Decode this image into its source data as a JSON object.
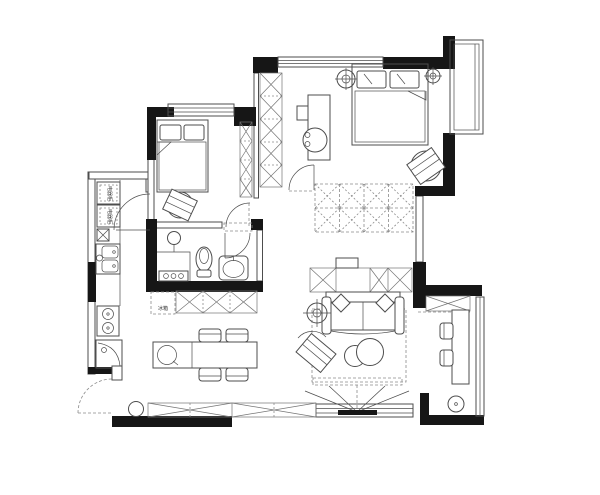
{
  "document": {
    "type": "apartment-floor-plan",
    "background": "#ffffff"
  },
  "colors": {
    "wall": "#161616",
    "line": "#4d4d4d",
    "hatch": "#757575",
    "dash": "#8a8a8a",
    "text": "#333333"
  },
  "labels": {
    "fridge": "冰箱",
    "kitchen_cabinet_top": "电器柜",
    "kitchen_cabinet_bottom": "电器柜"
  },
  "rooms": [
    {
      "name": "second-bedroom",
      "position": "top-left",
      "furniture": [
        "bed-with-two-pillows",
        "desk-chair",
        "wardrobe-column",
        "window",
        "door"
      ]
    },
    {
      "name": "master-bedroom",
      "position": "top-right",
      "furniture": [
        "double-bed-with-two-pillows",
        "ceiling-light",
        "ceiling-light",
        "dressing-table-with-stool",
        "lounge-chair",
        "double-row-wardrobe",
        "bay-window",
        "door"
      ]
    },
    {
      "name": "bathroom",
      "position": "middle-left",
      "furniture": [
        "makeup-mirror",
        "vanity-counter",
        "toilet",
        "wash-basin",
        "door"
      ]
    },
    {
      "name": "kitchen",
      "position": "left-strip",
      "furniture": [
        "appliance-cabinet",
        "appliance-cabinet",
        "double-bowl-sink",
        "two-burner-stove",
        "corner-counter",
        "door"
      ]
    },
    {
      "name": "dining-room",
      "position": "center",
      "furniture": [
        "refrigerator",
        "sideboard",
        "dining-table",
        "chair",
        "chair",
        "chair",
        "chair"
      ]
    },
    {
      "name": "living-room",
      "position": "center-right",
      "furniture": [
        "console-cabinet",
        "sofa",
        "throw-pillow",
        "throw-pillow",
        "floor-lamp",
        "armchair",
        "round-coffee-tables",
        "rug",
        "tv-with-view-lines",
        "window"
      ]
    },
    {
      "name": "balcony-study",
      "position": "bottom-right",
      "furniture": [
        "storage-cabinet",
        "desk",
        "chair",
        "chair",
        "floor-drain",
        "window"
      ]
    },
    {
      "name": "entry",
      "position": "bottom-left",
      "furniture": [
        "entry-door-swing",
        "stool",
        "shoe-cabinet"
      ]
    }
  ],
  "symbols": [
    {
      "name": "ceiling-light",
      "glyph": "circled-cross"
    },
    {
      "name": "door-swing",
      "glyph": "quarter-arc"
    },
    {
      "name": "cabinet-hatch",
      "glyph": "crossed-box"
    },
    {
      "name": "floor-drain",
      "glyph": "dotted-circle"
    }
  ]
}
